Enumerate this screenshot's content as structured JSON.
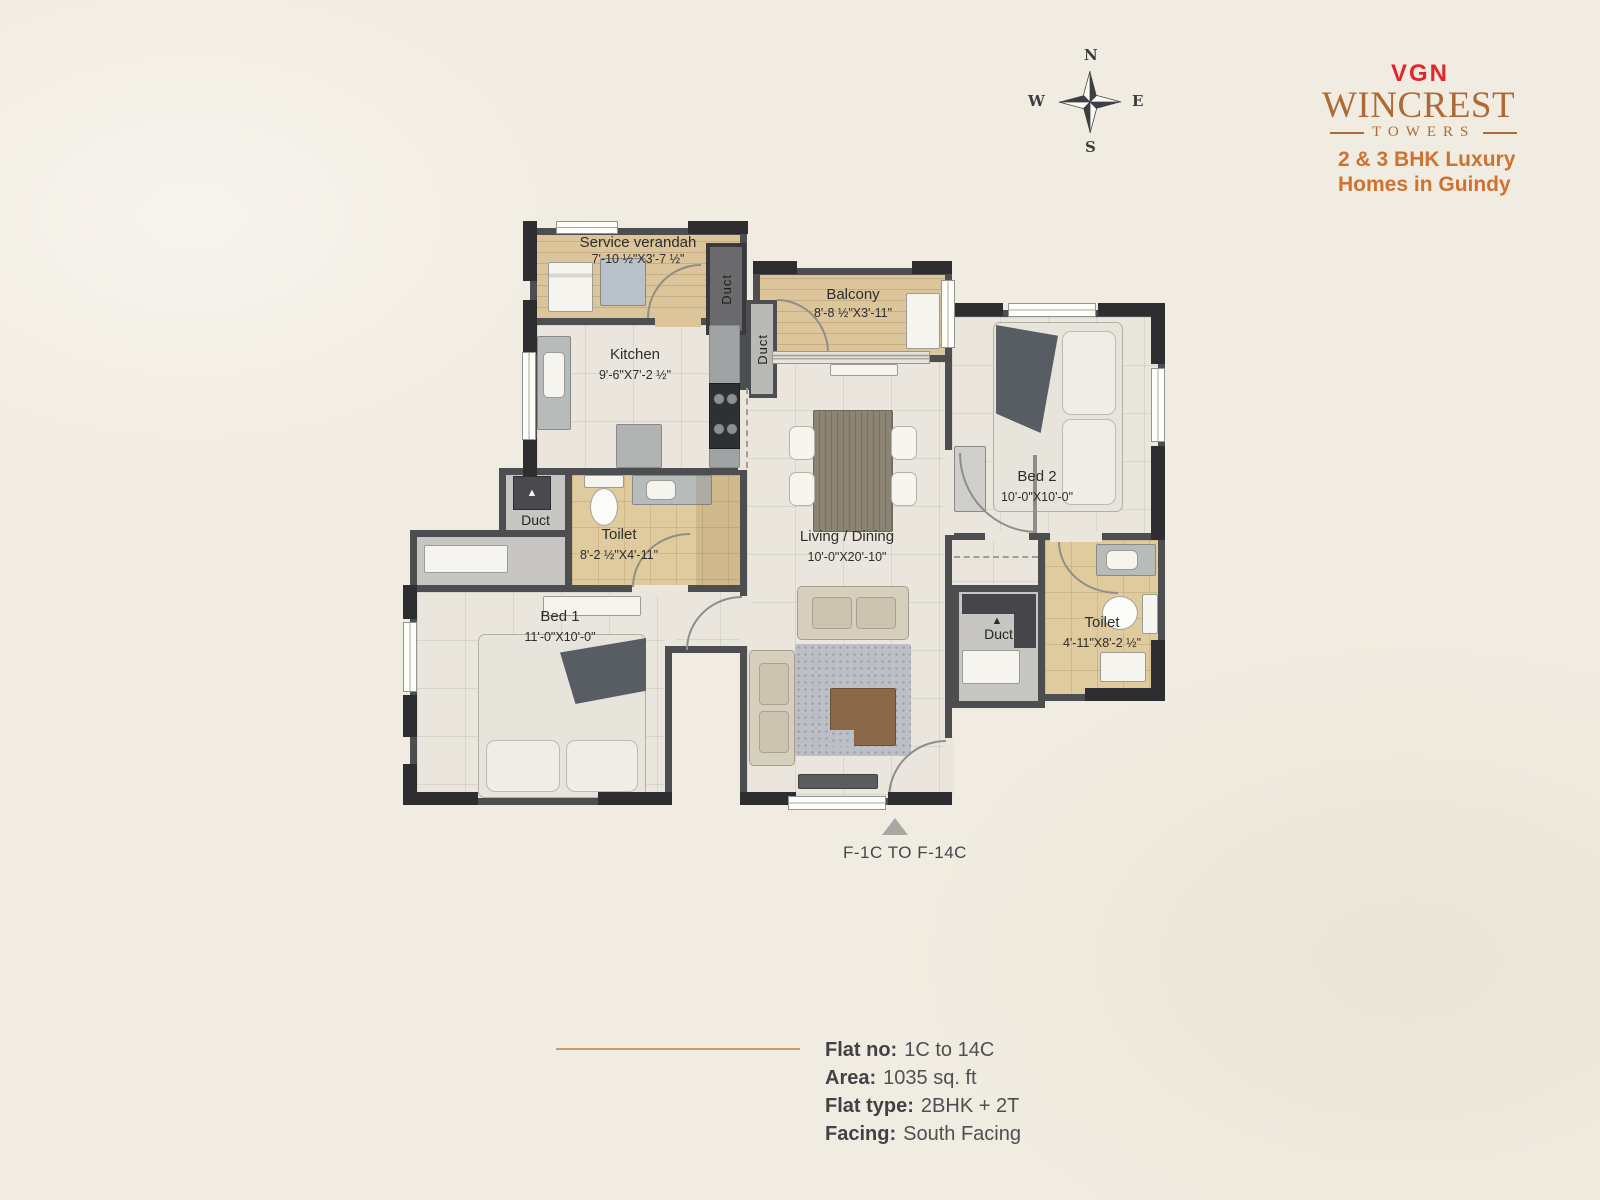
{
  "branding": {
    "company": "VGN",
    "project": "WINCREST",
    "sub": "TOWERS",
    "tagline_line1": "2 & 3 BHK Luxury",
    "tagline_line2": "Homes in Guindy",
    "company_color": "#e4252b",
    "brand_color": "#ad6a35",
    "tagline_color": "#cf7231"
  },
  "compass": {
    "north": "N",
    "east": "E",
    "south": "S",
    "west": "W"
  },
  "plan": {
    "rooms": [
      {
        "id": "service-verandah",
        "name": "Service verandah",
        "dim": "7'-10 ½\"X3'-7 ½\""
      },
      {
        "id": "kitchen",
        "name": "Kitchen",
        "dim": "9'-6\"X7'-2 ½\""
      },
      {
        "id": "balcony",
        "name": "Balcony",
        "dim": "8'-8 ½\"X3'-11\""
      },
      {
        "id": "living-dining",
        "name": "Living / Dining",
        "dim": "10'-0\"X20'-10\""
      },
      {
        "id": "bed-2",
        "name": "Bed 2",
        "dim": "10'-0\"X10'-0\""
      },
      {
        "id": "toilet-1",
        "name": "Toilet",
        "dim": "8'-2 ½\"X4'-11\""
      },
      {
        "id": "bed-1",
        "name": "Bed 1",
        "dim": "11'-0\"X10'-0\""
      },
      {
        "id": "toilet-2",
        "name": "Toilet",
        "dim": "4'-11\"X8'-2 ½\""
      }
    ],
    "ducts": {
      "verandah": "Duct",
      "balcony": "Duct",
      "left": "Duct",
      "right": "Duct"
    },
    "flat_range_label": "F-1C TO F-14C",
    "wall_color": "#4d4e50",
    "divider_color": "#cd9a6b"
  },
  "details": {
    "rows": [
      {
        "label": "Flat no:",
        "value": "1C to 14C"
      },
      {
        "label": "Area:",
        "value": "1035 sq. ft"
      },
      {
        "label": "Flat type:",
        "value": "2BHK + 2T"
      },
      {
        "label": "Facing:",
        "value": "South Facing"
      }
    ]
  }
}
